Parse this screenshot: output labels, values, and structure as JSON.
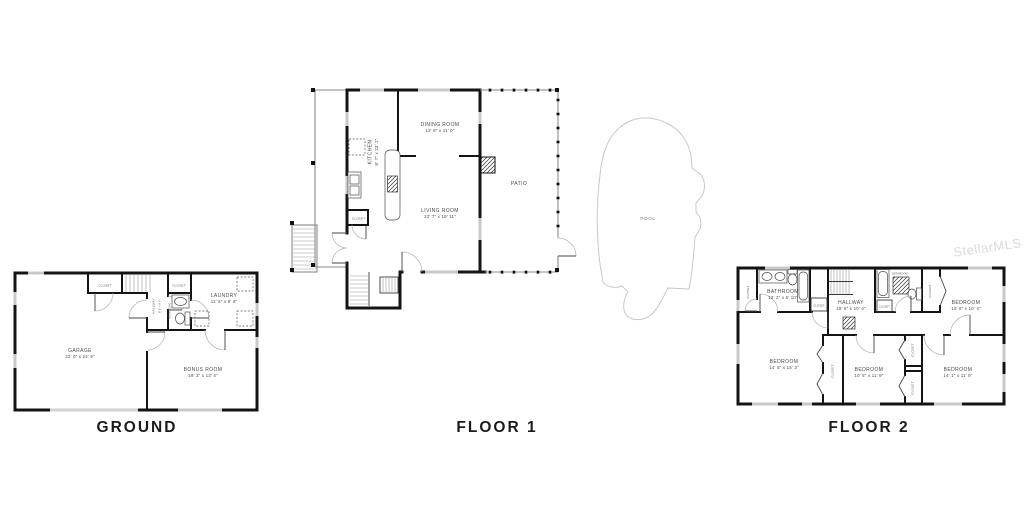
{
  "watermark": "StellarMLS",
  "pool": {
    "label": "POOL"
  },
  "ground": {
    "title": "GROUND",
    "garage_name": "GARAGE",
    "garage_dims": "22' 0\" x 22' 9\"",
    "bonus_name": "BONUS ROOM",
    "bonus_dims": "19' 3\" x 13' 4\"",
    "laundry_name": "LAUNDRY",
    "laundry_dims": "11' 5\" x 9' 0\"",
    "hallway_name": "HALLWAY",
    "hallway_dims": "8' 0\" x 9' 0\"",
    "bathroom_name": "BATHROOM",
    "closet_a": "CLOSET",
    "closet_b": "CLOSET"
  },
  "floor1": {
    "title": "FLOOR 1",
    "kitchen_name": "KITCHEN",
    "kitchen_dims": "8' 7\" x 23' 1\"",
    "dining_name": "DINING ROOM",
    "dining_dims": "13' 8\" x 11' 0\"",
    "living_name": "LIVING ROOM",
    "living_dims": "22' 7\" x 19' 11\"",
    "patio_name": "PATIO",
    "closet": "CLOSET"
  },
  "floor2": {
    "title": "FLOOR 2",
    "bathroom_name": "BATHROOM",
    "bathroom_dims": "12' 2\" x 6' 10\"",
    "bathroom2_name": "BATHROOM",
    "hallway_name": "HALLWAY",
    "hallway_dims": "18' 5\" x 10' 4\"",
    "bedroom_tr_name": "BEDROOM",
    "bedroom_tr_dims": "10' 8\" x 10' 4\"",
    "bedroom_bl_name": "BEDROOM",
    "bedroom_bl_dims": "14' 5\" x 15' 3\"",
    "bedroom_bm_name": "BEDROOM",
    "bedroom_bm_dims": "10' 5\" x 11' 9\"",
    "bedroom_br_name": "BEDROOM",
    "bedroom_br_dims": "14' 1\" x 11' 9\"",
    "closet_tl": "CLOSET",
    "closet_bath": "CLOSET",
    "closet_hall": "CLOSET",
    "closet_tr": "CLOSET",
    "closet_mid": "CLOSET",
    "closet_r1": "CLOSET",
    "closet_r2": "CLOSET"
  },
  "colors": {
    "wall": "#141414",
    "window": "#c9c9c9",
    "pool_outline": "#c8c8c8",
    "room_label": "#4a4a4a",
    "title": "#1b1b1b",
    "watermark": "#dbdbdb"
  }
}
